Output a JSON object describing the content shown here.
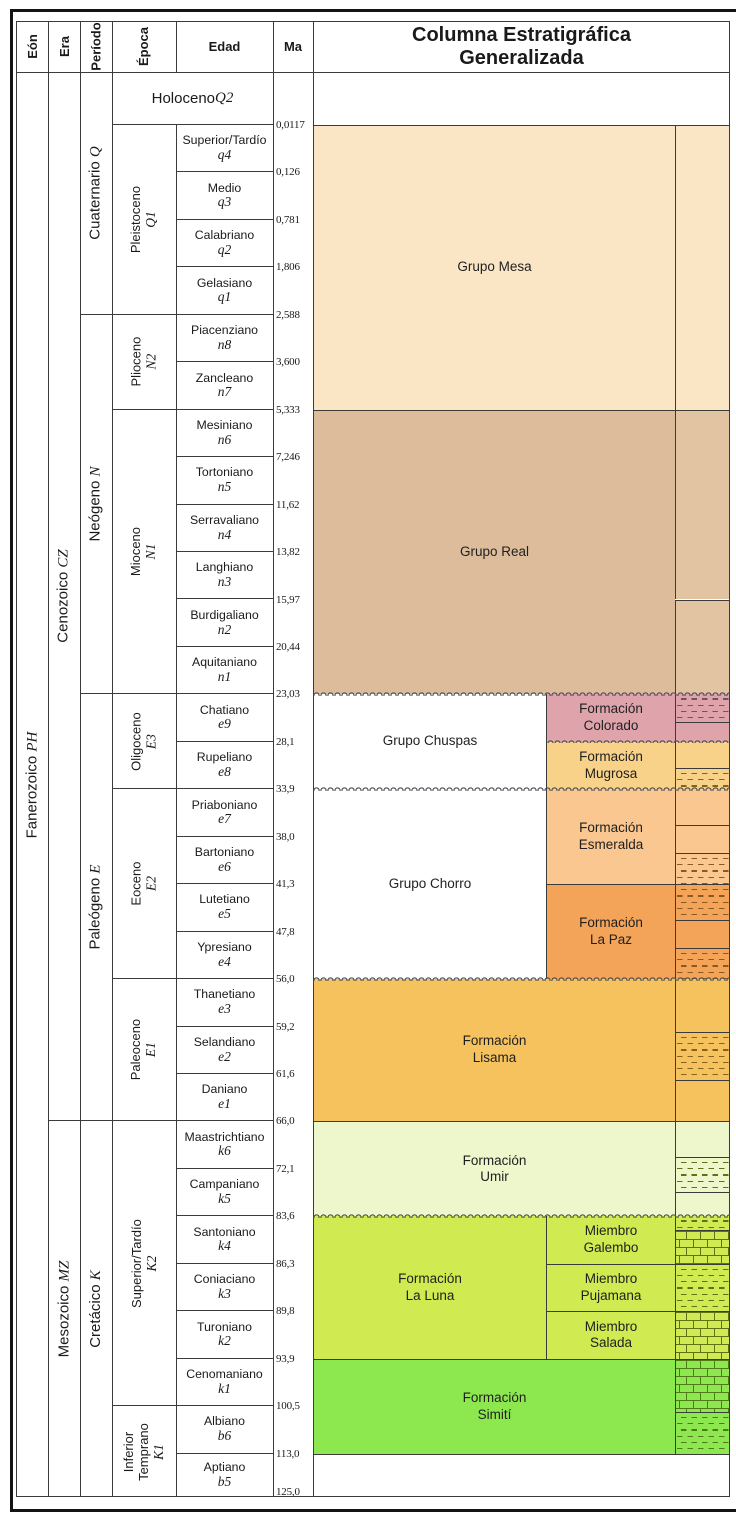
{
  "header": {
    "eon": "Eón",
    "era": "Era",
    "period": "Período",
    "epoch": "Época",
    "age": "Edad",
    "ma": "Ma",
    "title": "Columna Estratigráfica\nGeneralizada"
  },
  "chart_data": {
    "type": "table",
    "title": "Columna Estratigráfica Generalizada",
    "columns": [
      "Eón",
      "Era",
      "Período",
      "Época",
      "Edad",
      "Ma",
      "Columna Estratigráfica Generalizada"
    ],
    "eon": {
      "name": "Fanerozoico",
      "code": "PH",
      "from": "holocene",
      "to": "b5"
    },
    "eras": [
      {
        "name": "Cenozoico",
        "code": "CZ",
        "from": "holocene",
        "to": "e1"
      },
      {
        "name": "Mesozoico",
        "code": "MZ",
        "from": "k6",
        "to": "b5"
      }
    ],
    "periods": [
      {
        "name": "Cuaternario",
        "code": "Q",
        "from": "holocene",
        "to": "q1"
      },
      {
        "name": "Neógeno",
        "code": "N",
        "from": "n8",
        "to": "n1"
      },
      {
        "name": "Paleógeno",
        "code": "E",
        "from": "e9",
        "to": "e1"
      },
      {
        "name": "Cretácico",
        "code": "K",
        "from": "k6",
        "to": "b5"
      }
    ],
    "holocene": {
      "name": "Holoceno",
      "code": "Q2",
      "ma": "0,0117"
    },
    "epochs": [
      {
        "name": "Pleistoceno",
        "code": "Q1",
        "from": "q4",
        "to": "q1"
      },
      {
        "name": "Plioceno",
        "code": "N2",
        "from": "n8",
        "to": "n7"
      },
      {
        "name": "Mioceno",
        "code": "N1",
        "from": "n6",
        "to": "n1"
      },
      {
        "name": "Oligoceno",
        "code": "E3",
        "from": "e9",
        "to": "e8"
      },
      {
        "name": "Eoceno",
        "code": "E2",
        "from": "e7",
        "to": "e4"
      },
      {
        "name": "Paleoceno",
        "code": "E1",
        "from": "e3",
        "to": "e1"
      },
      {
        "name": "Superior/Tardío",
        "code": "K2",
        "from": "k6",
        "to": "k1"
      },
      {
        "name": "Inferior Temprano",
        "code": "K1",
        "from": "b6",
        "to": "b5",
        "lines": [
          "Inferior",
          "Temprano"
        ]
      }
    ],
    "ages": [
      {
        "name": "Superior/Tardío",
        "code": "q4",
        "ma": "0,126"
      },
      {
        "name": "Medio",
        "code": "q3",
        "ma": "0,781"
      },
      {
        "name": "Calabriano",
        "code": "q2",
        "ma": "1,806"
      },
      {
        "name": "Gelasiano",
        "code": "q1",
        "ma": "2,588"
      },
      {
        "name": "Piacenziano",
        "code": "n8",
        "ma": "3,600"
      },
      {
        "name": "Zancleano",
        "code": "n7",
        "ma": "5,333"
      },
      {
        "name": "Mesiniano",
        "code": "n6",
        "ma": "7,246"
      },
      {
        "name": "Tortoniano",
        "code": "n5",
        "ma": "11,62"
      },
      {
        "name": "Serravaliano",
        "code": "n4",
        "ma": "13,82"
      },
      {
        "name": "Langhiano",
        "code": "n3",
        "ma": "15,97"
      },
      {
        "name": "Burdigaliano",
        "code": "n2",
        "ma": "20,44"
      },
      {
        "name": "Aquitaniano",
        "code": "n1",
        "ma": "23,03"
      },
      {
        "name": "Chatiano",
        "code": "e9",
        "ma": "28,1"
      },
      {
        "name": "Rupeliano",
        "code": "e8",
        "ma": "33,9"
      },
      {
        "name": "Priaboniano",
        "code": "e7",
        "ma": "38,0"
      },
      {
        "name": "Bartoniano",
        "code": "e6",
        "ma": "41,3"
      },
      {
        "name": "Lutetiano",
        "code": "e5",
        "ma": "47,8"
      },
      {
        "name": "Ypresiano",
        "code": "e4",
        "ma": "56,0"
      },
      {
        "name": "Thanetiano",
        "code": "e3",
        "ma": "59,2"
      },
      {
        "name": "Selandiano",
        "code": "e2",
        "ma": "61,6"
      },
      {
        "name": "Daniano",
        "code": "e1",
        "ma": "66,0"
      },
      {
        "name": "Maastrichtiano",
        "code": "k6",
        "ma": "72,1"
      },
      {
        "name": "Campaniano",
        "code": "k5",
        "ma": "83,6"
      },
      {
        "name": "Santoniano",
        "code": "k4",
        "ma": "86,3"
      },
      {
        "name": "Coniaciano",
        "code": "k3",
        "ma": "89,8"
      },
      {
        "name": "Turoniano",
        "code": "k2",
        "ma": "93,9"
      },
      {
        "name": "Cenomaniano",
        "code": "k1",
        "ma": "100,5"
      },
      {
        "name": "Albiano",
        "code": "b6",
        "ma": "113,0"
      },
      {
        "name": "Aptiano",
        "code": "b5",
        "ma": "125,0"
      }
    ],
    "colors": {
      "mesa": "#FAE6C5",
      "real": "#DDBC9B",
      "realstrip": "#E2C3A2",
      "colorado": "#DFA3AC",
      "mugrosa": "#F8D289",
      "esmeralda": "#F9C78F",
      "lapaz": "#F4A458",
      "lisama": "#F6C25E",
      "umir": "#EEF6CB",
      "laluna": "#D0EA51",
      "simiti": "#8DE850",
      "white": "#FFFFFF"
    },
    "formations": [
      {
        "label": "Grupo Mesa",
        "from": "q4",
        "to": "n7",
        "span": "full",
        "color": "mesa"
      },
      {
        "label": "Grupo Real",
        "from": "n6",
        "to": "n1",
        "span": "full",
        "color": "real"
      },
      {
        "label": "Grupo Chuspas",
        "from": "e9",
        "to": "e8",
        "span": "left",
        "color": "white",
        "wavy_top": true
      },
      {
        "label": "Formación\nColorado",
        "from": "e9",
        "to": "e9",
        "span": "right",
        "color": "colorado",
        "wavy_top": true
      },
      {
        "label": "Formación\nMugrosa",
        "from": "e8",
        "to": "e8",
        "span": "right",
        "color": "mugrosa",
        "wavy_top": true
      },
      {
        "label": "Grupo Chorro",
        "from": "e7",
        "to": "e4",
        "span": "left",
        "color": "white",
        "wavy_top": true
      },
      {
        "label": "Formación\nEsmeralda",
        "from": "e7",
        "to": "e6",
        "span": "right",
        "color": "esmeralda",
        "wavy_top": true
      },
      {
        "label": "Formación\nLa Paz",
        "from": "e5",
        "to": "e4",
        "span": "right",
        "color": "lapaz"
      },
      {
        "label": "Formación\nLisama",
        "from": "e3",
        "to": "e1",
        "span": "full",
        "color": "lisama",
        "wavy_top": true
      },
      {
        "label": "Formación\nUmir",
        "from": "k6",
        "to": "k5",
        "span": "full",
        "color": "umir"
      },
      {
        "label": "Formación\nLa Luna",
        "from": "k4",
        "to": "k2",
        "span": "left",
        "color": "laluna",
        "wavy_top": true
      },
      {
        "label": "Miembro\nGalembo",
        "from": "k4",
        "to": "k4",
        "span": "right",
        "color": "laluna",
        "wavy_top": true
      },
      {
        "label": "Miembro\nPujamana",
        "from": "k3",
        "to": "k3",
        "span": "right",
        "color": "laluna"
      },
      {
        "label": "Miembro\nSalada",
        "from": "k2",
        "to": "k2",
        "span": "right",
        "color": "laluna"
      },
      {
        "label": "Formación\nSimití",
        "from": "k1",
        "to": "b6",
        "span": "full",
        "color": "simiti"
      },
      {
        "label": "",
        "from": "b5",
        "to": "b5",
        "span": "chart",
        "color": "white"
      }
    ],
    "unconformities": [
      {
        "after": "n1",
        "span": "chart"
      },
      {
        "after": "e9",
        "span": "right"
      },
      {
        "after": "e8",
        "span": "chart"
      },
      {
        "after": "e4",
        "span": "chart"
      },
      {
        "after": "k5",
        "span": "chart"
      }
    ],
    "lithology": [
      {
        "y0": 125,
        "y1": 409.7,
        "pattern": "circles",
        "bg": "mesa",
        "ink": "#8a6a50"
      },
      {
        "y0": 409.7,
        "y1": 599.5,
        "pattern": "dots",
        "bg": "realstrip",
        "ink": "#7c5f45"
      },
      {
        "y0": 599.5,
        "y1": 694.4,
        "pattern": "circles",
        "bg": "realstrip",
        "ink": "#7c5f45"
      },
      {
        "y0": 694.4,
        "y1": 722,
        "pattern": "dashes",
        "bg": "colorado",
        "ink": "#6e5560"
      },
      {
        "y0": 722,
        "y1": 741.85,
        "pattern": "dots",
        "bg": "colorado",
        "ink": "#6e5560"
      },
      {
        "y0": 741.85,
        "y1": 768,
        "pattern": "circles",
        "bg": "mugrosa",
        "ink": "#86621c"
      },
      {
        "y0": 768,
        "y1": 789.3,
        "pattern": "dashes",
        "bg": "mugrosa",
        "ink": "#86621c"
      },
      {
        "y0": 789.3,
        "y1": 825,
        "pattern": "dots",
        "bg": "esmeralda",
        "ink": "#8a5a20"
      },
      {
        "y0": 825,
        "y1": 853,
        "pattern": "hlines",
        "bg": "esmeralda",
        "ink": "#8a5a20"
      },
      {
        "y0": 853,
        "y1": 884.2,
        "pattern": "dashes",
        "bg": "esmeralda",
        "ink": "#8a5a20"
      },
      {
        "y0": 884.2,
        "y1": 920,
        "pattern": "dashes",
        "bg": "lapaz",
        "ink": "#8a5a20"
      },
      {
        "y0": 920,
        "y1": 948,
        "pattern": "dots",
        "bg": "lapaz",
        "ink": "#8a5a20"
      },
      {
        "y0": 948,
        "y1": 979.1,
        "pattern": "dashes",
        "bg": "lapaz",
        "ink": "#8a5a20"
      },
      {
        "y0": 979.1,
        "y1": 1032,
        "pattern": "hlines",
        "bg": "lisama",
        "ink": "#86621c"
      },
      {
        "y0": 1032,
        "y1": 1080,
        "pattern": "dashes",
        "bg": "lisama",
        "ink": "#86621c"
      },
      {
        "y0": 1080,
        "y1": 1121.45,
        "pattern": "dots",
        "bg": "lisama",
        "ink": "#86621c"
      },
      {
        "y0": 1121.45,
        "y1": 1157,
        "pattern": "hlines",
        "bg": "umir",
        "ink": "#5f7018"
      },
      {
        "y0": 1157,
        "y1": 1192,
        "pattern": "dashes",
        "bg": "umir",
        "ink": "#5f7018"
      },
      {
        "y0": 1192,
        "y1": 1216.35,
        "pattern": "hlines",
        "bg": "umir",
        "ink": "#5f7018"
      },
      {
        "y0": 1216.35,
        "y1": 1230,
        "pattern": "dashes",
        "bg": "laluna",
        "ink": "#5f7018"
      },
      {
        "y0": 1230,
        "y1": 1263.8,
        "pattern": "brick",
        "bg": "laluna",
        "ink": "#5f7018"
      },
      {
        "y0": 1263.8,
        "y1": 1311.25,
        "pattern": "dashes",
        "bg": "laluna",
        "ink": "#5f7018"
      },
      {
        "y0": 1311.25,
        "y1": 1358.7,
        "pattern": "brick",
        "bg": "laluna",
        "ink": "#5f7018"
      },
      {
        "y0": 1358.7,
        "y1": 1412,
        "pattern": "brick",
        "bg": "simiti",
        "ink": "#4f7a18"
      },
      {
        "y0": 1412,
        "y1": 1453.6,
        "pattern": "dashes",
        "bg": "simiti",
        "ink": "#4f7a18"
      }
    ]
  }
}
